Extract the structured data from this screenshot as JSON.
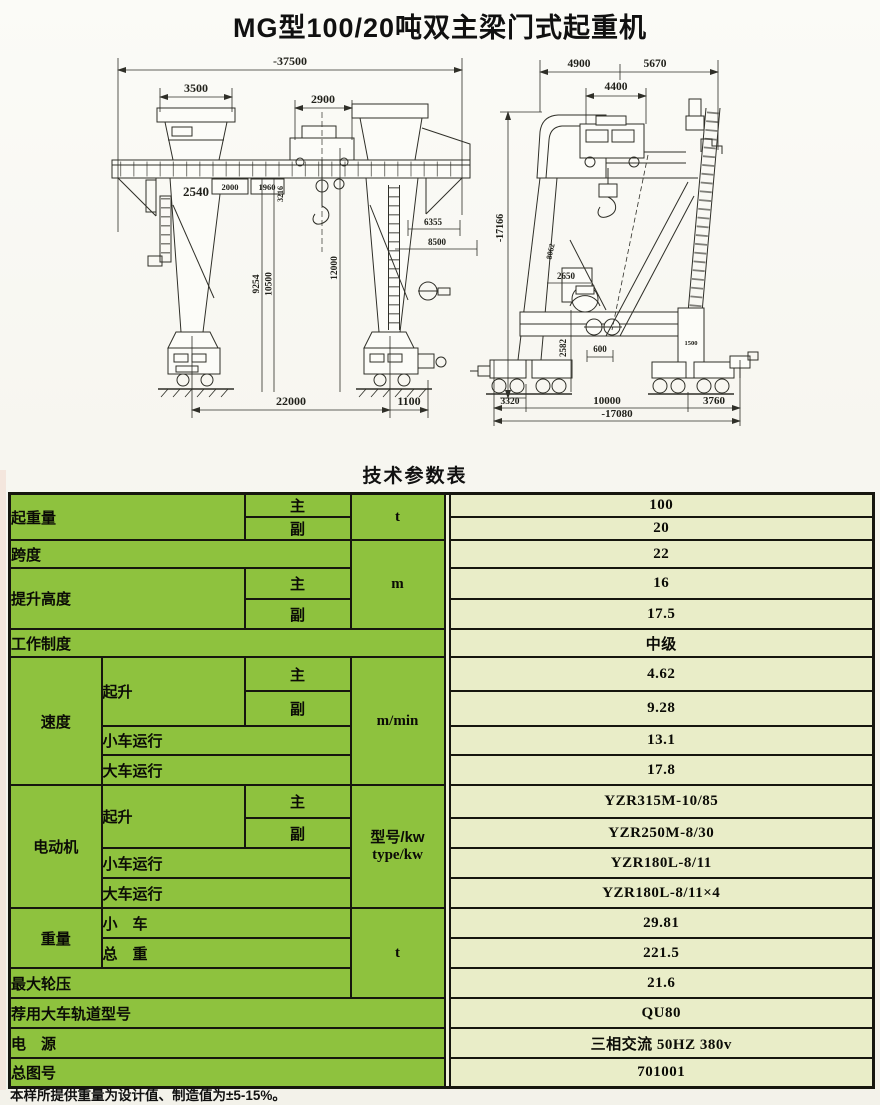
{
  "page": {
    "title": "MG型100/20吨双主梁门式起重机",
    "table_heading": "技术参数表",
    "footnote": "本样所提供重量为设计值、制造值为±5-15%。"
  },
  "colors": {
    "table_green": "#8ec23e",
    "table_value_bg": "#e9edc8",
    "border": "#16160e"
  },
  "front_view": {
    "dims": {
      "overall": "-37500",
      "leg_top": "3500",
      "trolley": "2900",
      "leg": "2540",
      "box_a": "2000",
      "box_b": "1960",
      "girder": "3216",
      "h1": "9254",
      "h2": "10500",
      "h3": "12000",
      "r1": "6355",
      "r2": "8500",
      "span": "22000",
      "overhang": "1100"
    }
  },
  "side_view": {
    "dims": {
      "top_a": "4900",
      "top_b": "5670",
      "trolley": "4400",
      "height": "-17166",
      "diag": "8062",
      "mid": "2650",
      "vert": "2582",
      "gauge": "600",
      "leg": "1500",
      "b1": "3320",
      "b2": "10000",
      "b3": "3760",
      "base": "-17080"
    }
  },
  "table": {
    "units": {
      "capacity": "t",
      "length": "m",
      "speed": "m/min",
      "motor_cn": "型号/kw",
      "motor_en": "type/kw",
      "weight": "t"
    },
    "capacity": {
      "label": "起重量",
      "main": "主",
      "aux": "副",
      "main_value": "100",
      "aux_value": "20"
    },
    "span": {
      "label": "跨度",
      "value": "22"
    },
    "height": {
      "label": "提升高度",
      "main": "主",
      "aux": "副",
      "main_value": "16",
      "aux_value": "17.5"
    },
    "duty": {
      "label": "工作制度",
      "value": "中级"
    },
    "speed": {
      "label": "速度",
      "hoist": "起升",
      "main": "主",
      "aux": "副",
      "trolley": "小车运行",
      "gantry": "大车运行",
      "hoist_main": "4.62",
      "hoist_aux": "9.28",
      "trolley_value": "13.1",
      "gantry_value": "17.8"
    },
    "motor": {
      "label": "电动机",
      "hoist": "起升",
      "main": "主",
      "aux": "副",
      "trolley": "小车运行",
      "gantry": "大车运行",
      "hoist_main": "YZR315M-10/85",
      "hoist_aux": "YZR250M-8/30",
      "trolley_value": "YZR180L-8/11",
      "gantry_value": "YZR180L-8/11×4"
    },
    "weight": {
      "label": "重量",
      "trolley": "小　车",
      "total": "总　重",
      "trolley_value": "29.81",
      "total_value": "221.5"
    },
    "wheel_load": {
      "label": "最大轮压",
      "value": "21.6"
    },
    "rail": {
      "label": "荐用大车轨道型号",
      "value": "QU80"
    },
    "power": {
      "label": "电　源",
      "value": "三相交流 50HZ 380v"
    },
    "drawing_no": {
      "label": "总图号",
      "value": "701001"
    }
  }
}
